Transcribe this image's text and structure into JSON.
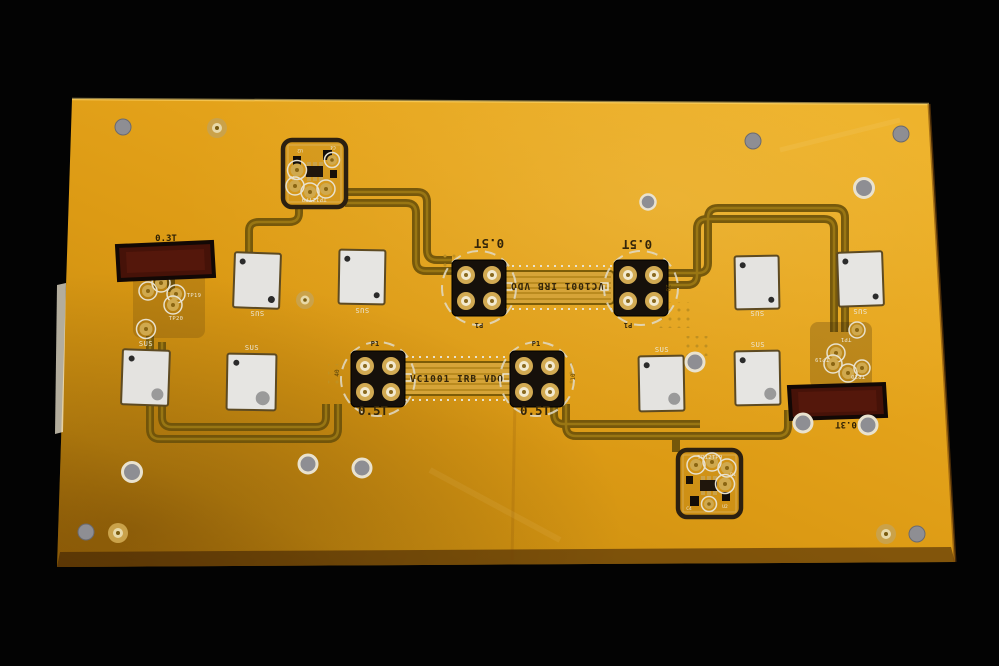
{
  "photo": {
    "subject": "Flexible printed circuit panel (flex PCB) photographed on a black background",
    "colors": {
      "background": "#030303",
      "board_light": "#edb026",
      "board_dark": "#a86f08",
      "copper_trace": "#6d520a",
      "silkscreen_white": "#ece6d4",
      "dark_print": "#33250a",
      "stiffener_white": "#e4e3e0",
      "tape_maroon": "#461208",
      "connector_black": "#16100a",
      "pad_gold": "#d2aa52"
    }
  },
  "labels": {
    "part_number": "VC1001 IRB VDO",
    "thickness_half": "0.5T",
    "thickness_third": "0.3T",
    "connector_ref": "P1",
    "stiffener": "SUS",
    "pin40": "40",
    "pin10": "10",
    "pin20": "20",
    "testpoint_block": "TP12TP9",
    "tp6": "TP6",
    "tp1": "TP1",
    "tp19": "TP19",
    "tp20": "TP20",
    "r1": "R1",
    "u2": "U2",
    "c4": "C4"
  }
}
